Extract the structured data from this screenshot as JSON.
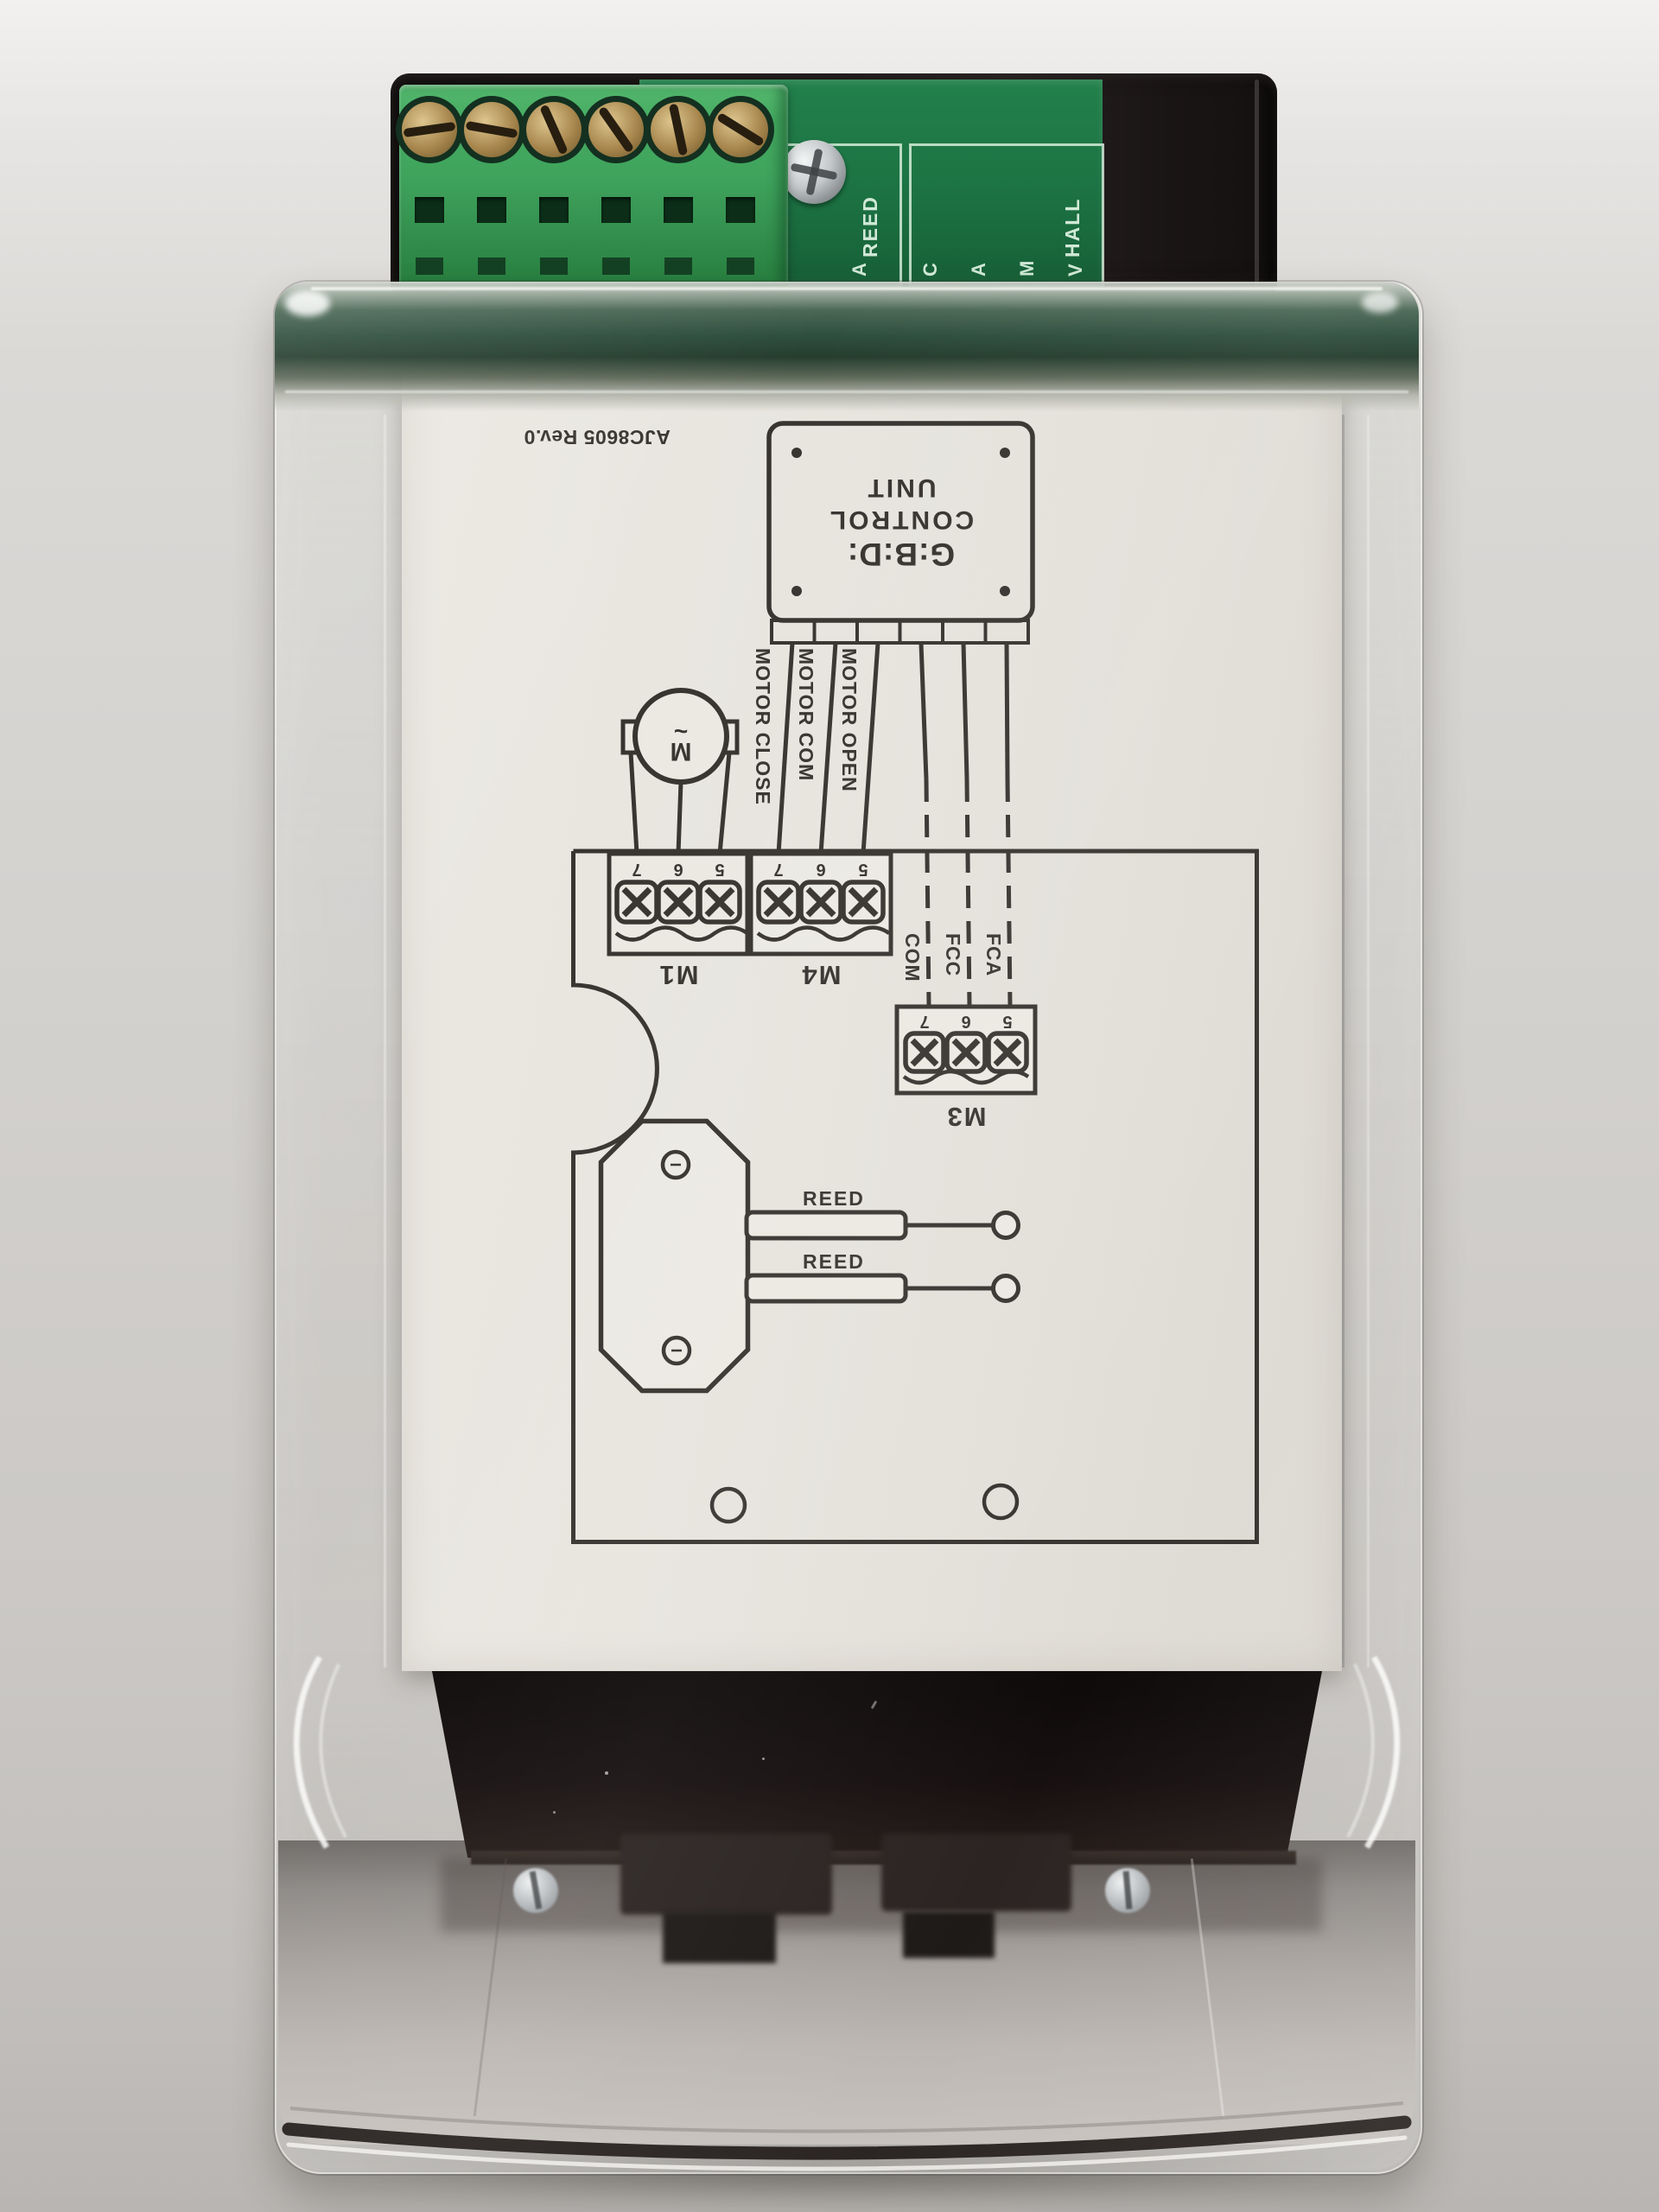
{
  "pcb": {
    "reed_header": "REED",
    "reed_pins": [
      "M",
      "C",
      "A"
    ],
    "hall_header": "HALL",
    "hall_pins": [
      "C",
      "A",
      "M",
      "V"
    ]
  },
  "paper": {
    "doc_code": "AJC8605 Rev.0",
    "unit_box": {
      "brand": "G:B:D:",
      "line1": "CONTROL",
      "line2": "UNIT"
    },
    "motor_wire_labels": [
      "MOTOR CLOSE",
      "MOTOR COM",
      "MOTOR OPEN"
    ],
    "limit_wire_labels": [
      "COM",
      "FCC",
      "FCA"
    ],
    "terminal_m1": "M1",
    "terminal_m4": "M4",
    "terminal_m3": "M3",
    "pin_numbers": [
      "7",
      "6",
      "5"
    ],
    "reed_label_1": "REED",
    "reed_label_2": "REED",
    "motor_letter": "M",
    "motor_wave": "~"
  },
  "colors": {
    "wall": "#d3d1ce",
    "housing_black": "#171313",
    "terminal_green": "#3fa35c",
    "pcb_green": "#1c7243",
    "silkscreen": "#dbf0df",
    "paper": "#e8e5df",
    "ink": "#3b3733",
    "brass": "#a8874e",
    "chrome": "#c6cacd"
  }
}
